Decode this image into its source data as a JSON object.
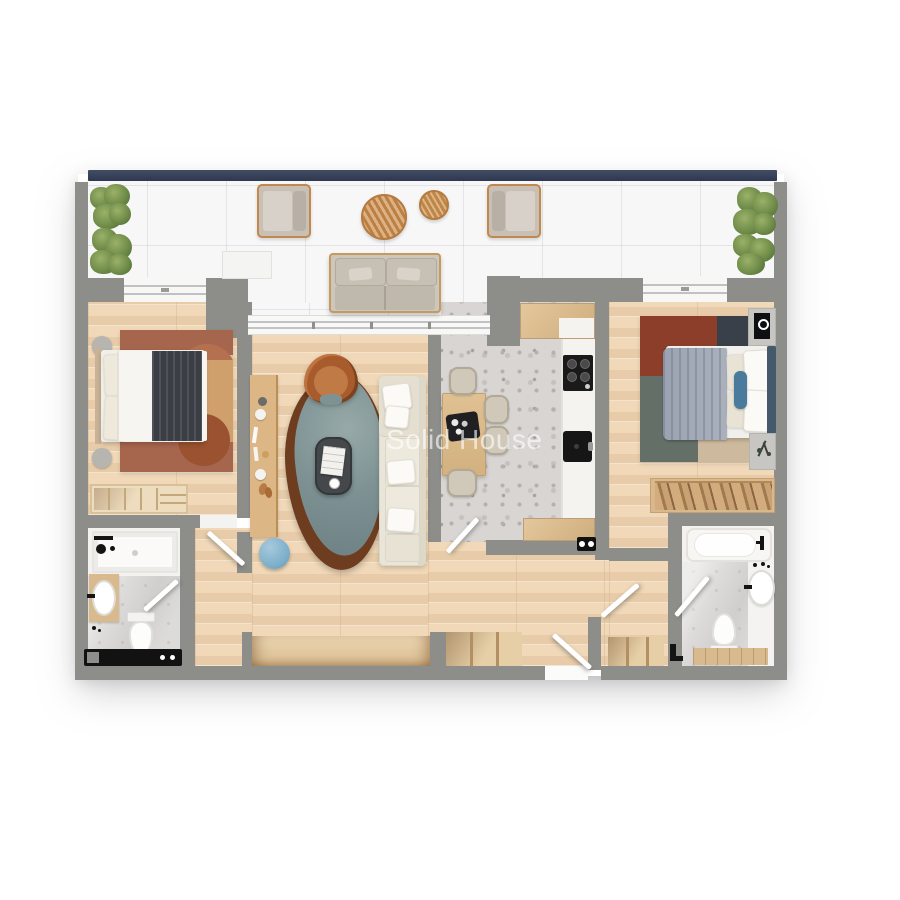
{
  "watermark": {
    "text": "Solid House"
  },
  "plan": {
    "title": "two-bedroom-apartment-floor-plan",
    "rooms": [
      {
        "name": "balcony",
        "floor": "white-marble-tile",
        "items": [
          "plant-box",
          "plant-box",
          "lounge-armchair-left",
          "lounge-armchair-right",
          "round-table-large",
          "round-table-small",
          "outdoor-sofa",
          "storage-box",
          "plant-box",
          "plant-box",
          "glass-railing"
        ]
      },
      {
        "name": "bedroom-left",
        "floor": "oak-parquet",
        "items": [
          "double-bed",
          "charcoal-bed-runner",
          "terracotta-area-rug",
          "round-side-table",
          "round-side-table",
          "open-wardrobe",
          "window"
        ]
      },
      {
        "name": "living-room",
        "floor": "oak-parquet",
        "items": [
          "sideboard-console",
          "organic-teal-rug",
          "leather-armchair",
          "coffee-table",
          "sectional-sofa",
          "blue-floor-pouf",
          "sliding-glass-door"
        ]
      },
      {
        "name": "kitchen-dining",
        "floor": "terrazzo",
        "items": [
          "dining-table",
          "dining-chair",
          "dining-chair",
          "dining-chair",
          "dining-chair",
          "coffee-tray",
          "kitchen-counter",
          "gas-hob",
          "kitchen-sink",
          "upper-cabinet",
          "lower-cabinet",
          "power-socket"
        ]
      },
      {
        "name": "bedroom-right",
        "floor": "oak-parquet",
        "items": [
          "double-bed",
          "gray-throw-blanket",
          "color-block-rug",
          "nightstand-with-art",
          "nightstand-with-plant",
          "wardrobe-with-clothes",
          "window"
        ]
      },
      {
        "name": "bathroom-left",
        "floor": "marble",
        "items": [
          "walk-in-shower",
          "shower-fixture",
          "washbasin-vanity",
          "toilet",
          "towel-radiator",
          "door"
        ]
      },
      {
        "name": "bathroom-right",
        "floor": "marble",
        "items": [
          "bathtub",
          "round-washbasin",
          "toilet",
          "wooden-bath-mat",
          "door"
        ]
      },
      {
        "name": "hallway",
        "floor": "oak-parquet",
        "items": [
          "built-in-closet",
          "shelved-closet",
          "shelved-closet",
          "entry-door",
          "bedroom-door",
          "bathroom-door",
          "kitchen-door",
          "bedroom-door",
          "bathroom-door"
        ]
      }
    ],
    "colors": {
      "wall": "#8d8d89",
      "railing_navy": "#37415a",
      "wood_floor": "#edd5b6",
      "balcony_tile": "#f7f7f8",
      "terrazzo": "#d8d5d3",
      "rug_teal": "#7e9294",
      "rug_rim_brown": "#6e3d1f",
      "leather_chair": "#b26c3c",
      "sofa_cream": "#e9e5d8",
      "pouf_blue": "#7fb0cc",
      "rug2_rust": "#8c3e2b",
      "rug2_navy": "#394049",
      "rug2_sage": "#646f68",
      "bed_runner_charcoal": "#3b3e44"
    }
  }
}
